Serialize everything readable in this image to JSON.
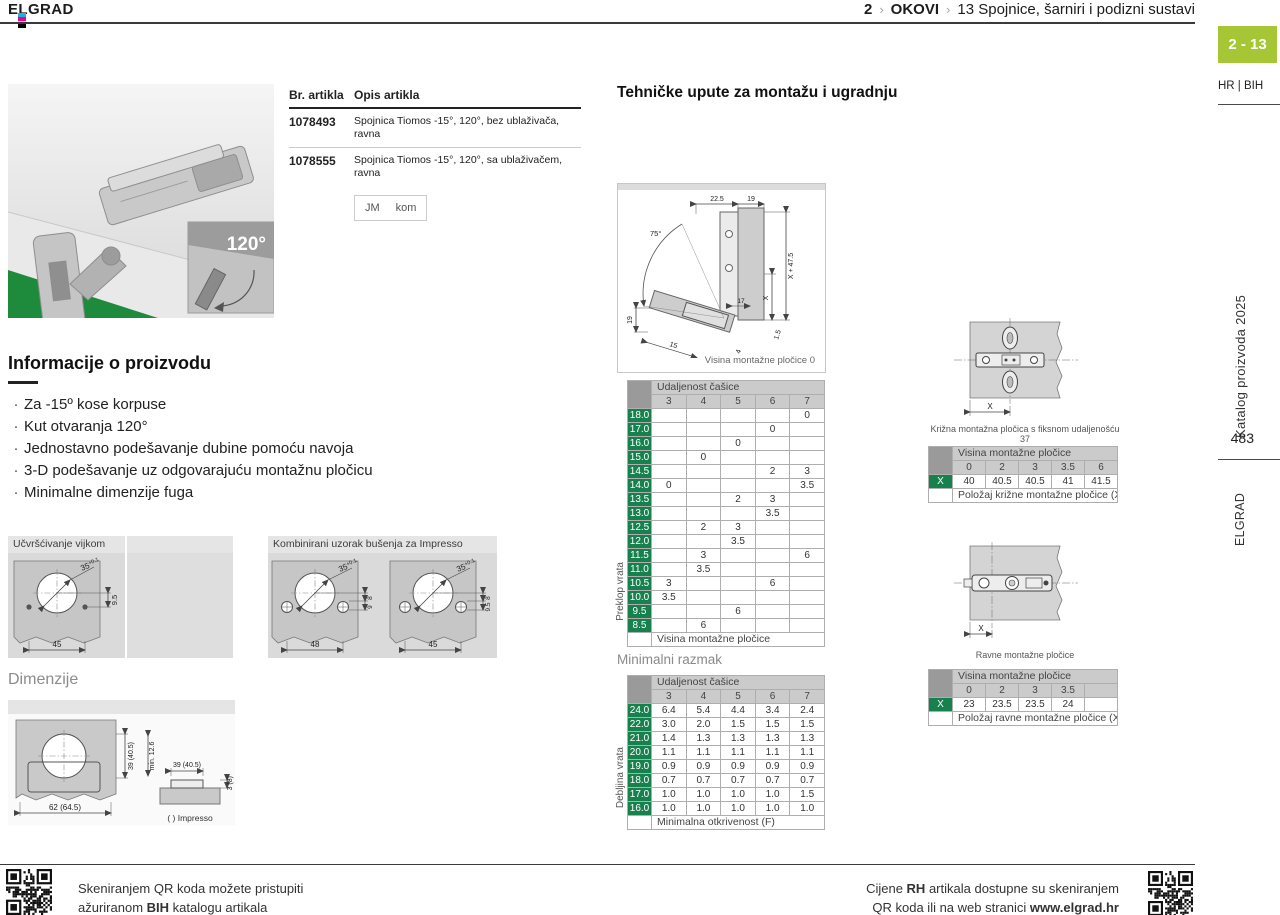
{
  "colors": {
    "accent": "#a6c636",
    "green": "#17814d",
    "hdrgray": "#cbcbcb",
    "crngray": "#9a9a9a",
    "floor": "#1e8a3c",
    "reg_c": "#29abe2",
    "reg_m": "#ec008c",
    "reg_y": "#fff200",
    "reg_k": "#000000"
  },
  "header": {
    "brand": "ELGRAD",
    "breadcrumb": {
      "level": "2",
      "sep": "›",
      "section": "OKOVI",
      "chapter": "13",
      "title": "Spojnice, šarniri i podizni sustavi"
    }
  },
  "sidebar": {
    "page_tab": "2 - 13",
    "lang": "HR | BIH",
    "catalog": "Katalog proizvoda 2025",
    "page_number": "483",
    "brand_vertical": "ELGRAD"
  },
  "product_image": {
    "angle_label": "120°"
  },
  "products": {
    "col_code": "Br. artikla",
    "col_desc": "Opis artikla",
    "items": [
      {
        "code": "1078493",
        "desc": "Spojnica Tiomos -15°, 120°, bez ublaživača, ravna"
      },
      {
        "code": "1078555",
        "desc": "Spojnica Tiomos -15°, 120°, sa ublaživačem, ravna"
      }
    ],
    "unit_label": "JM",
    "unit_value": "kom"
  },
  "info": {
    "title": "Informacije o proizvodu",
    "bullets": [
      "Za -15º kose korpuse",
      "Kut otvaranja 120°",
      "Jednostavno podešavanje dubine pomoću navoja",
      "3-D podešavanje uz odgovarajuću montažnu pločicu",
      "Minimalne dimenzije fuga"
    ]
  },
  "drawings": {
    "screw": {
      "title": "Učvršćivanje vijkom",
      "dia": "35",
      "tol": "+0.1",
      "depth": "9.5",
      "width": "45"
    },
    "impresso": {
      "title": "Kombinirani uzorak bušenja za Impresso",
      "dia": "35",
      "tol": "+0.1",
      "left_width": "48",
      "right_width": "45",
      "d8": "8",
      "d9": "9",
      "d95": "9.5"
    },
    "dims": {
      "title": "Dimenzije",
      "side": "39 (40.5)",
      "bottom": "62 (64.5)",
      "min_depth": "min. 12.6",
      "top": "39 (40.5)",
      "plate": "3 (8)",
      "note": "( ) Impresso"
    }
  },
  "tech": {
    "title": "Tehničke upute za montažu i ugradnju",
    "caption": "Visina montažne pločice 0",
    "dims": {
      "t1": "22.5",
      "t2": "19",
      "angle": "75°",
      "r1": "X + 47.5",
      "r2": "X",
      "m17": "17",
      "l19": "19",
      "b15": "15",
      "b4": "4",
      "b1_5": "1.5"
    }
  },
  "tables": {
    "overlay": {
      "group_header": "Udaljenost čašice",
      "columns": [
        "3",
        "4",
        "5",
        "6",
        "7"
      ],
      "side_label": "Preklop vrata",
      "rows": [
        {
          "label": "18.0",
          "values": [
            "",
            "",
            "",
            "",
            "0"
          ]
        },
        {
          "label": "17.0",
          "values": [
            "",
            "",
            "",
            "0",
            ""
          ]
        },
        {
          "label": "16.0",
          "values": [
            "",
            "",
            "0",
            "",
            ""
          ]
        },
        {
          "label": "15.0",
          "values": [
            "",
            "0",
            "",
            "",
            ""
          ]
        },
        {
          "label": "14.5",
          "values": [
            "",
            "",
            "",
            "2",
            "3"
          ]
        },
        {
          "label": "14.0",
          "values": [
            "0",
            "",
            "",
            "",
            "3.5"
          ]
        },
        {
          "label": "13.5",
          "values": [
            "",
            "",
            "2",
            "3",
            ""
          ]
        },
        {
          "label": "13.0",
          "values": [
            "",
            "",
            "",
            "3.5",
            ""
          ]
        },
        {
          "label": "12.5",
          "values": [
            "",
            "2",
            "3",
            "",
            ""
          ]
        },
        {
          "label": "12.0",
          "values": [
            "",
            "",
            "3.5",
            "",
            ""
          ]
        },
        {
          "label": "11.5",
          "values": [
            "",
            "3",
            "",
            "",
            "6"
          ]
        },
        {
          "label": "11.0",
          "values": [
            "",
            "3.5",
            "",
            "",
            ""
          ]
        },
        {
          "label": "10.5",
          "values": [
            "3",
            "",
            "",
            "6",
            ""
          ]
        },
        {
          "label": "10.0",
          "values": [
            "3.5",
            "",
            "",
            "",
            ""
          ]
        },
        {
          "label": "9.5",
          "values": [
            "",
            "",
            "6",
            "",
            ""
          ]
        },
        {
          "label": "8.5",
          "values": [
            "",
            "6",
            "",
            "",
            ""
          ]
        }
      ],
      "footer": "Visina montažne pločice"
    },
    "min_gap_title": "Minimalni razmak",
    "min_gap": {
      "group_header": "Udaljenost čašice",
      "columns": [
        "3",
        "4",
        "5",
        "6",
        "7"
      ],
      "side_label": "Debljina vrata",
      "rows": [
        {
          "label": "24.0",
          "values": [
            "6.4",
            "5.4",
            "4.4",
            "3.4",
            "2.4"
          ]
        },
        {
          "label": "22.0",
          "values": [
            "3.0",
            "2.0",
            "1.5",
            "1.5",
            "1.5"
          ]
        },
        {
          "label": "21.0",
          "values": [
            "1.4",
            "1.3",
            "1.3",
            "1.3",
            "1.3"
          ]
        },
        {
          "label": "20.0",
          "values": [
            "1.1",
            "1.1",
            "1.1",
            "1.1",
            "1.1"
          ]
        },
        {
          "label": "19.0",
          "values": [
            "0.9",
            "0.9",
            "0.9",
            "0.9",
            "0.9"
          ]
        },
        {
          "label": "18.0",
          "values": [
            "0.7",
            "0.7",
            "0.7",
            "0.7",
            "0.7"
          ]
        },
        {
          "label": "17.0",
          "values": [
            "1.0",
            "1.0",
            "1.0",
            "1.0",
            "1.5"
          ]
        },
        {
          "label": "16.0",
          "values": [
            "1.0",
            "1.0",
            "1.0",
            "1.0",
            "1.0"
          ]
        }
      ],
      "footer": "Minimalna otkrivenost (F)"
    },
    "cross_plate": {
      "caption": "Križna montažna pločica s fiksnom udaljenošću 37",
      "group_header": "Visina montažne pločice",
      "columns": [
        "0",
        "2",
        "3",
        "3.5",
        "6"
      ],
      "rows": [
        {
          "label": "X",
          "values": [
            "40",
            "40.5",
            "40.5",
            "41",
            "41.5"
          ]
        }
      ],
      "footer": "Položaj križne montažne pločice (X)"
    },
    "flat_plate": {
      "caption": "Ravne montažne pločice",
      "group_header": "Visina montažne pločice",
      "columns": [
        "0",
        "2",
        "3",
        "3.5",
        ""
      ],
      "rows": [
        {
          "label": "X",
          "values": [
            "23",
            "23.5",
            "23.5",
            "24",
            ""
          ]
        }
      ],
      "footer": "Položaj ravne montažne pločice (X)"
    },
    "x_label": "X"
  },
  "footer": {
    "left_line1": "Skeniranjem QR koda možete pristupiti",
    "left_line2_pre": "ažuriranom ",
    "left_line2_bold": "BIH",
    "left_line2_post": " katalogu artikala",
    "right_line1_pre": "Cijene ",
    "right_line1_bold": "RH",
    "right_line1_post": " artikala dostupne su skeniranjem",
    "right_line2_pre": "QR koda ili na web stranici ",
    "right_line2_bold": "www.elgrad.hr"
  }
}
